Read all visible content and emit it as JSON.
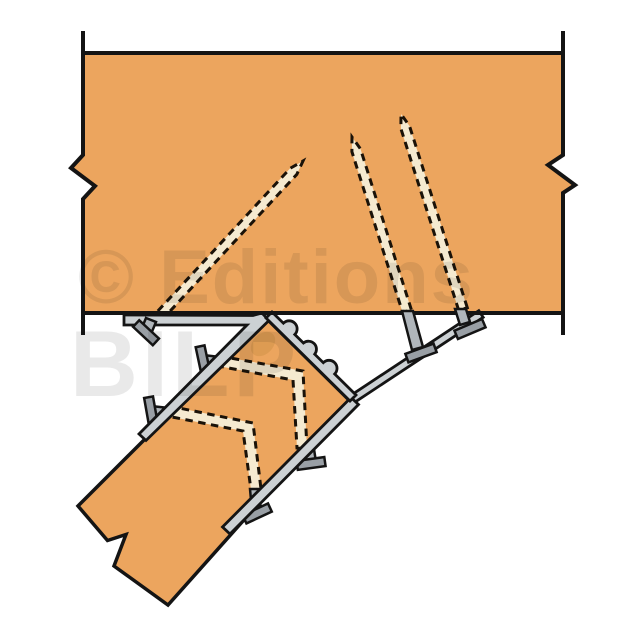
{
  "watermark": {
    "line1": "© Editions",
    "line2": "BILP"
  },
  "colors": {
    "background": "#ffffff",
    "wood": "#eca55e",
    "wood_knot": "#dd9b52",
    "metal_light": "#ccd1d4",
    "metal_mid": "#b0b6bb",
    "metal_dark": "#999fa5",
    "screw_fill": "#f5ead0",
    "dash": "#1a1208",
    "outline": "#141414",
    "watermark": "#e9e9e9"
  }
}
